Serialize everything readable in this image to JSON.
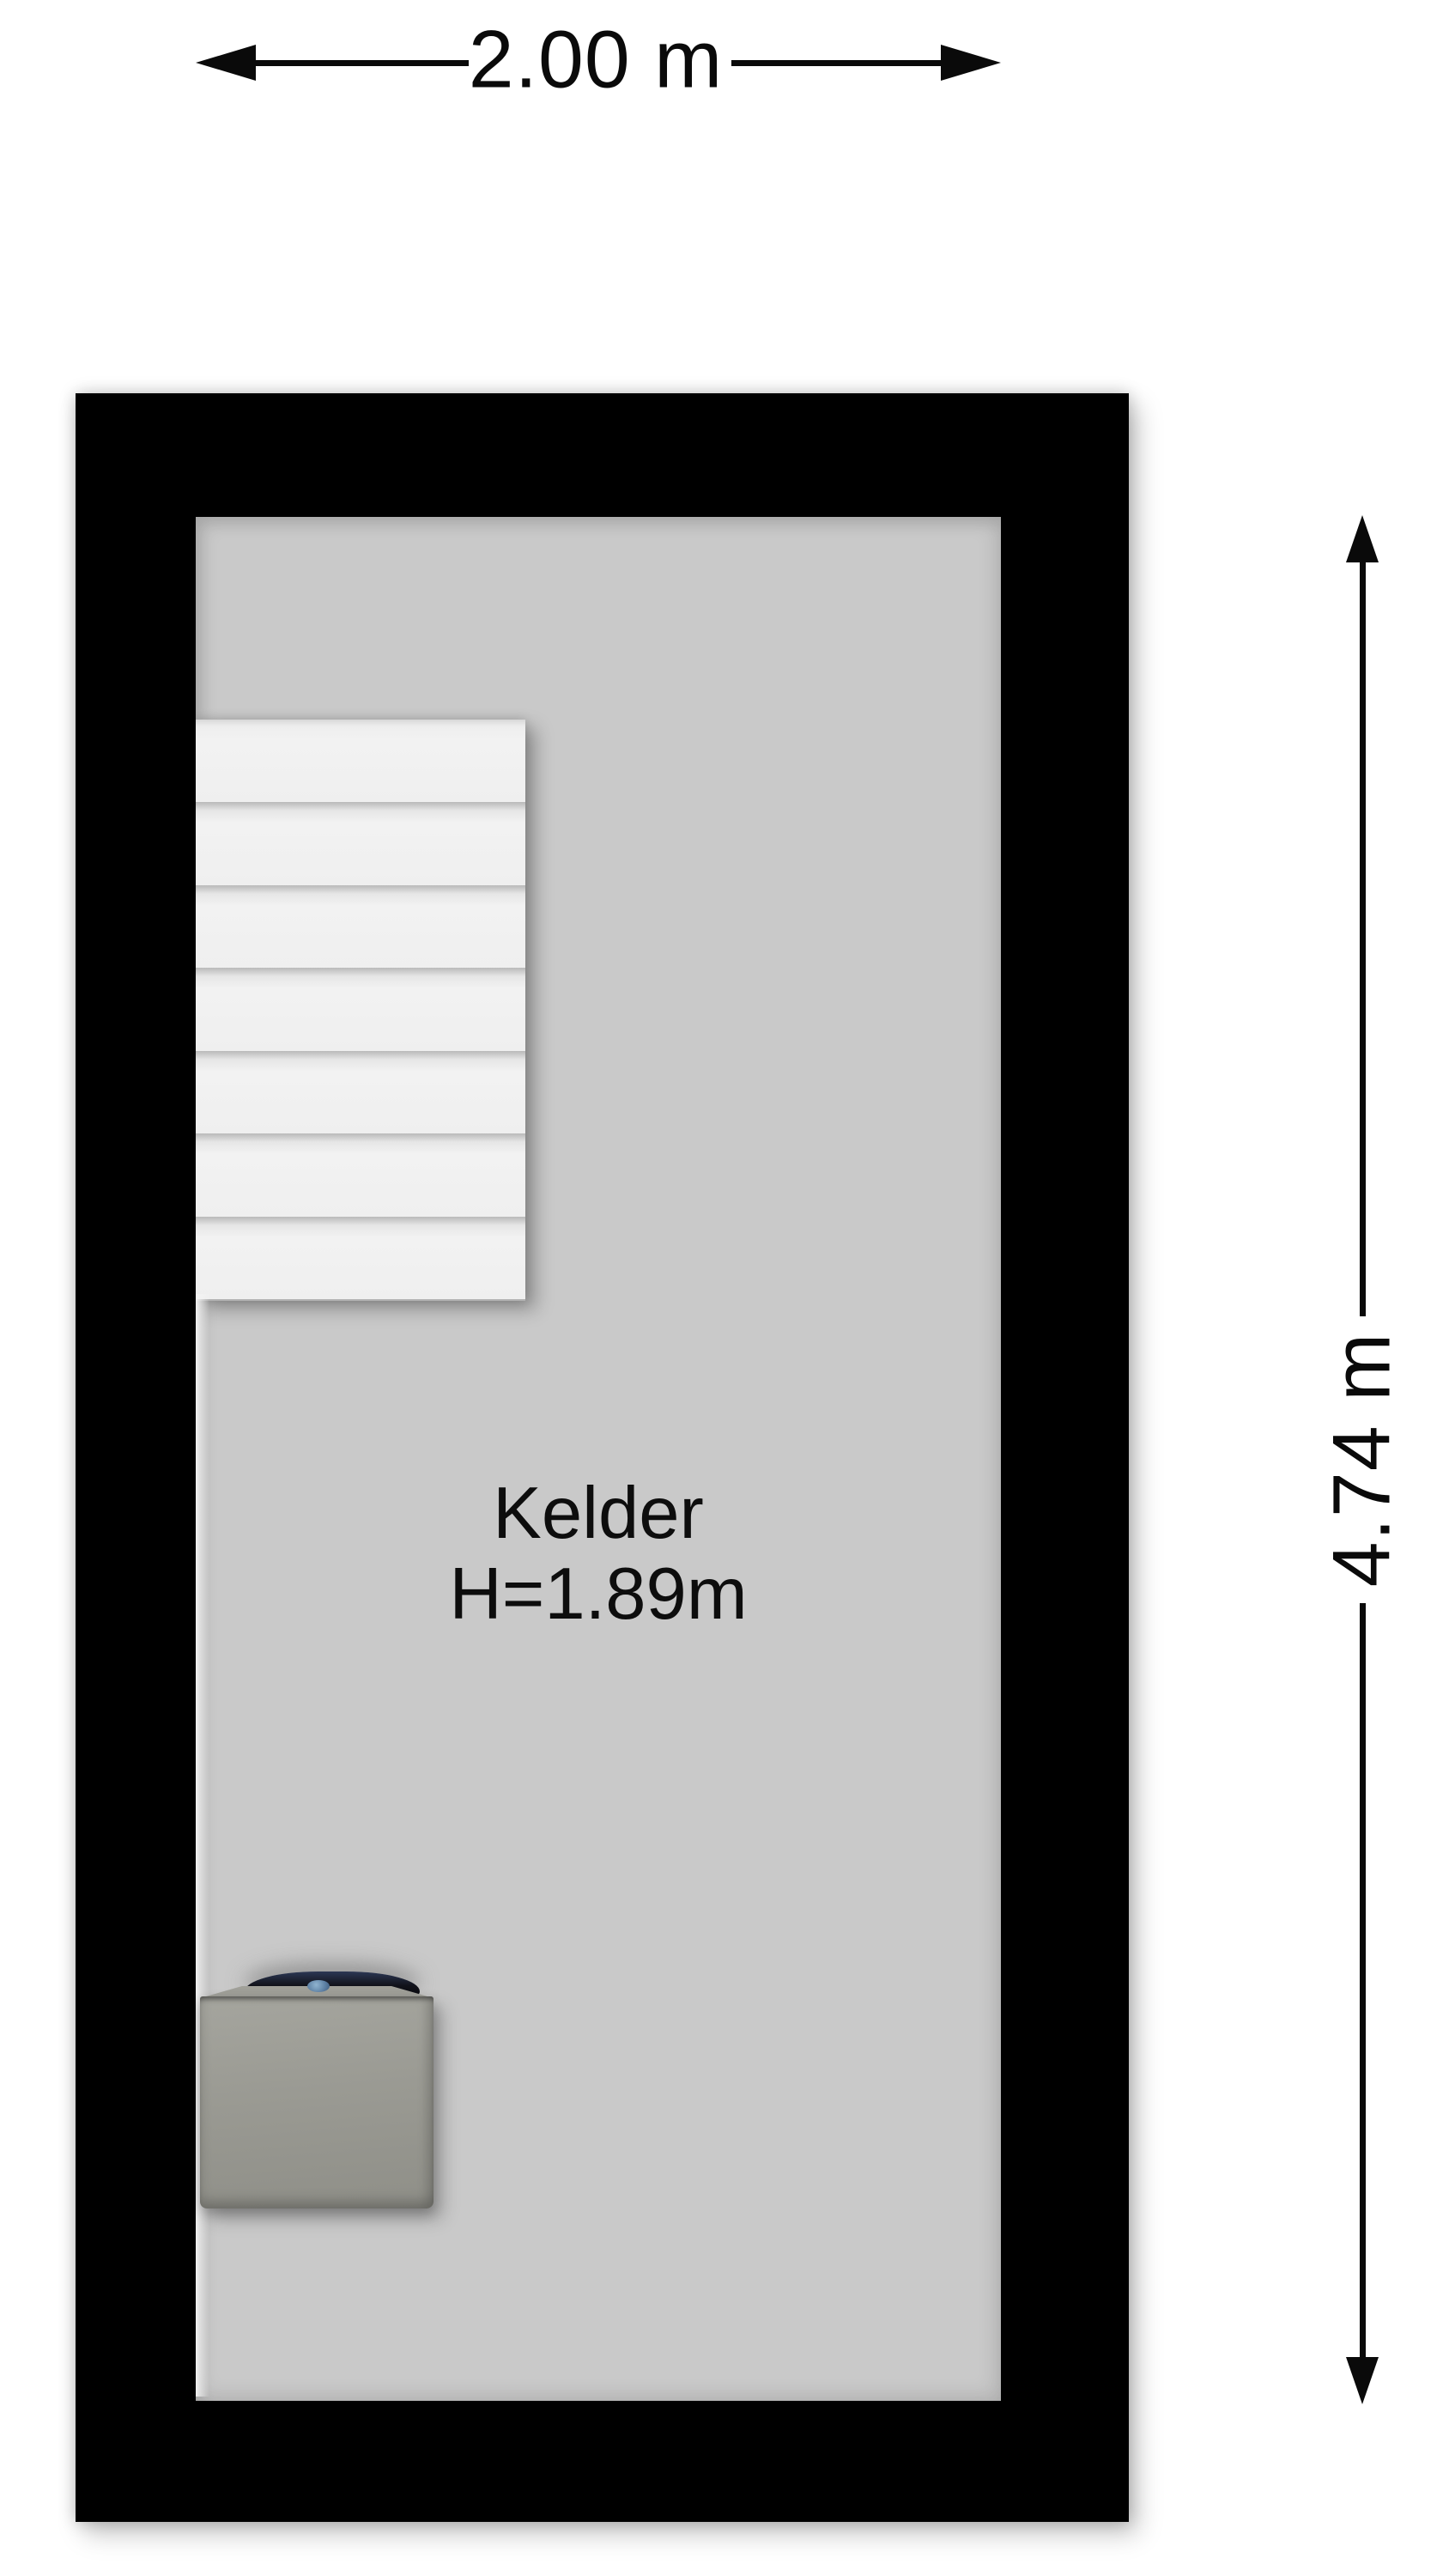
{
  "floorplan": {
    "room": {
      "name": "Kelder",
      "ceiling_height": "H=1.89m"
    },
    "dimensions": {
      "width_label": "2.00 m",
      "height_label": "4.74 m"
    },
    "stairs": {
      "treads": 7
    },
    "colors": {
      "background": "#ffffff",
      "wall": "#000000",
      "floor": "#c9c9c9",
      "stair_tread": "#f0f0f0",
      "dimension_ink": "#0a0a0a",
      "boiler_body": "#9a9a93",
      "boiler_cap": "#14161f",
      "boiler_accent": "#5c7fa3"
    }
  }
}
